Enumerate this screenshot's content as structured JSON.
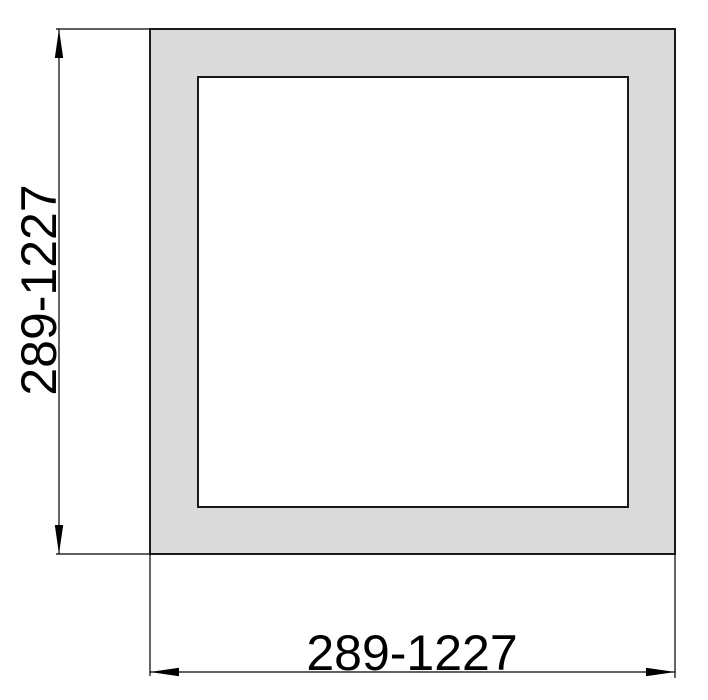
{
  "drawing": {
    "labels": {
      "width": "289-1227",
      "height": "289-1227"
    },
    "colors": {
      "section_fill": "#dadada",
      "bore_fill": "#ffffff",
      "line_color": "#000000",
      "background": "#ffffff"
    }
  }
}
